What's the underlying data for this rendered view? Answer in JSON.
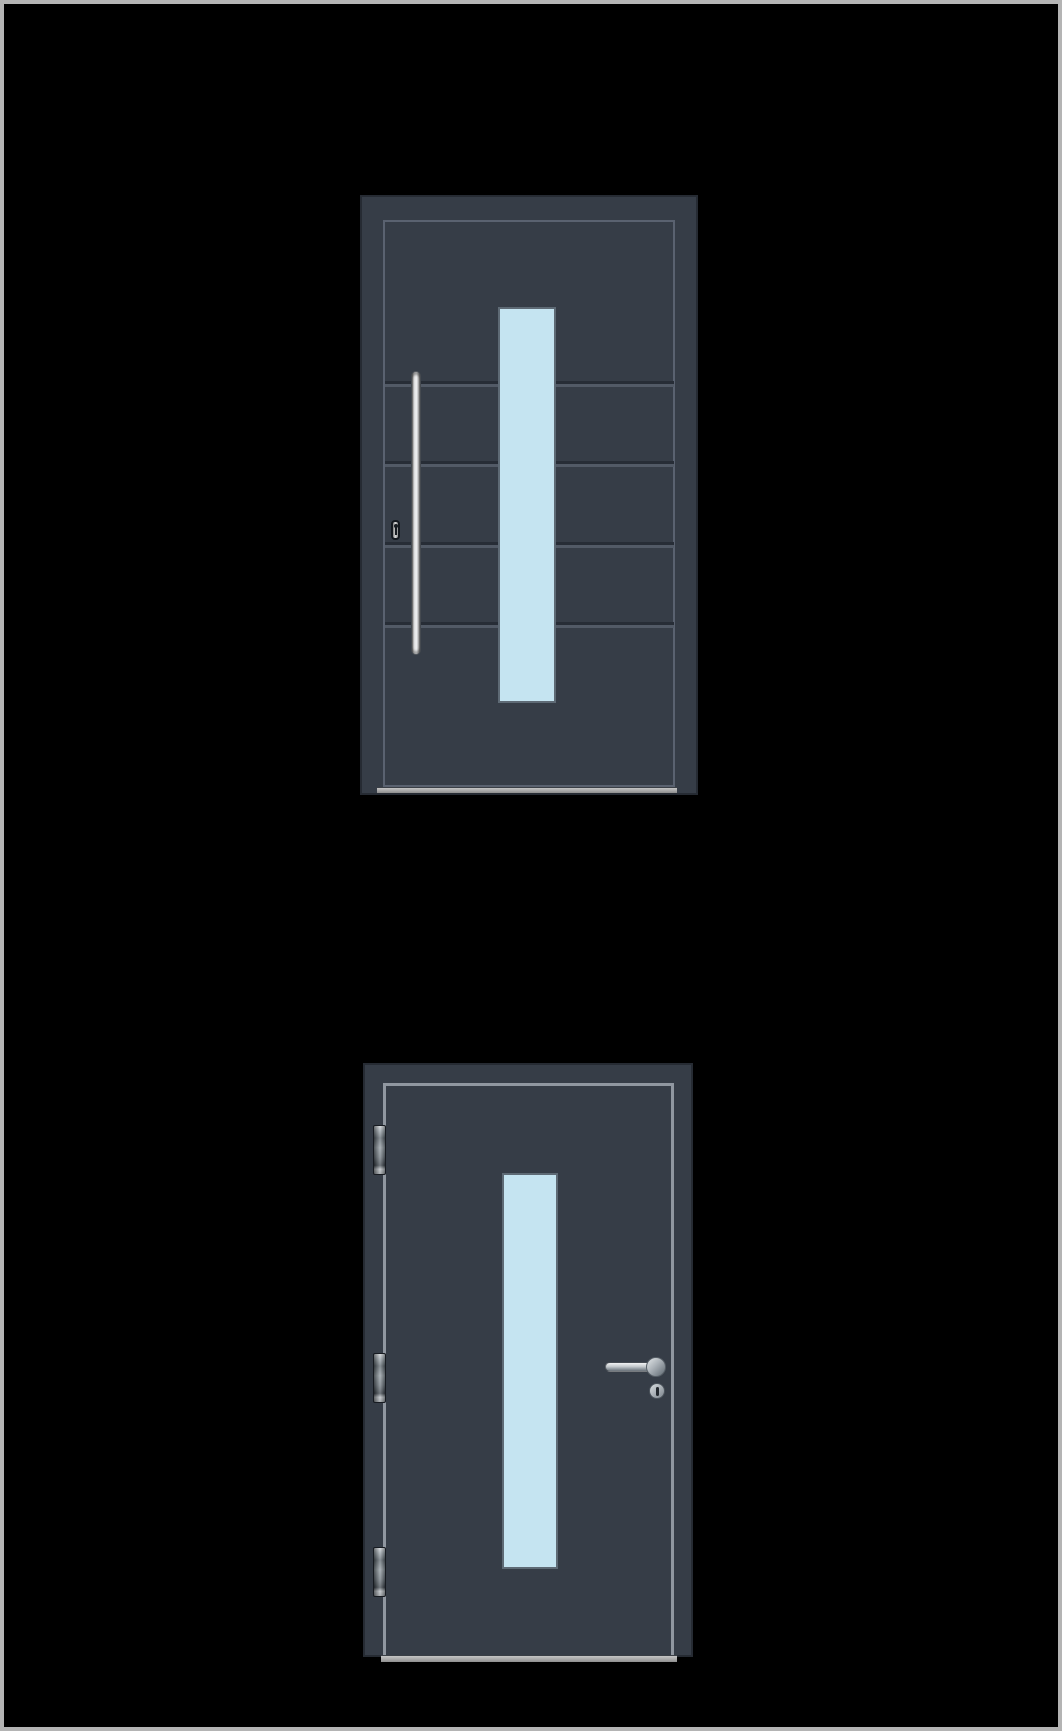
{
  "page": {
    "background_color": "#000000",
    "border_color": "#b4b4b4"
  },
  "colors": {
    "bg": "#000000",
    "page_border": "#b4b4b4",
    "door_fill": "#363d47",
    "door_edge": "#262b33",
    "inner_outline": "#5a6270",
    "leaf_outline": "#9097a0",
    "groove_dark": "#272d36",
    "groove_light": "#525a66",
    "glass_fill": "#c5e4f1",
    "glass_border": "#5e6a75",
    "threshold_light": "#c4c4c4",
    "threshold_dark": "#8f8f8f",
    "metal_light": "#f2f3f4",
    "metal_mid": "#aab1b7",
    "metal_dark": "#6a727a"
  },
  "figures": {
    "top_door": {
      "name": "entry-door-exterior-view",
      "glass_panels": 1,
      "groove_lines": 4,
      "hardware": [
        "vertical-bar-pull-handle",
        "keyhole-escutcheon"
      ]
    },
    "bottom_door": {
      "name": "entry-door-interior-view",
      "glass_panels": 1,
      "hinges": 3,
      "hardware": [
        "lever-handle",
        "handle-rose",
        "lock-cylinder"
      ]
    }
  }
}
